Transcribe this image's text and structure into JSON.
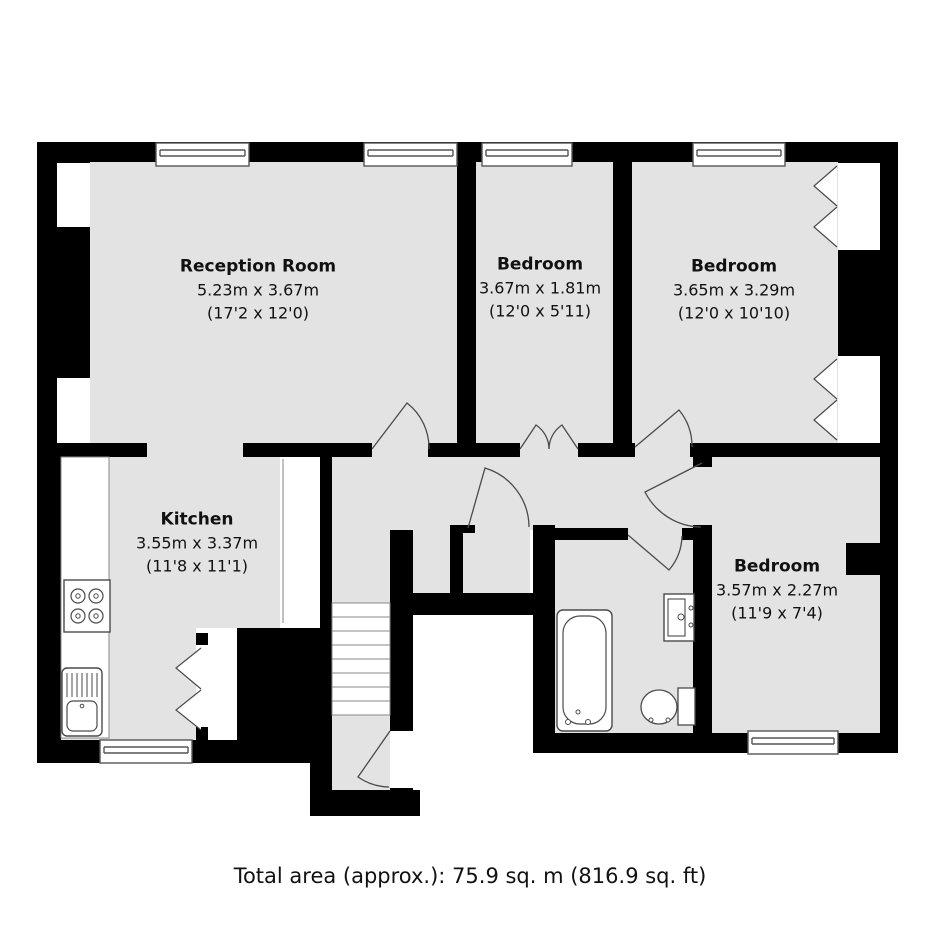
{
  "plan": {
    "type": "residential-floorplan",
    "rooms": [
      {
        "name": "Reception Room",
        "size_metric": "5.23m x 3.67m",
        "size_imperial": "(17'2 x 12'0)"
      },
      {
        "name": "Bedroom",
        "size_metric": "3.67m x 1.81m",
        "size_imperial": "(12'0 x 5'11)"
      },
      {
        "name": "Bedroom",
        "size_metric": "3.65m x 3.29m",
        "size_imperial": "(12'0 x 10'10)"
      },
      {
        "name": "Kitchen",
        "size_metric": "3.55m x 3.37m",
        "size_imperial": "(11'8 x 11'1)"
      },
      {
        "name": "Bedroom",
        "size_metric": "3.57m x 2.27m",
        "size_imperial": "(11'9 x 7'4)"
      }
    ],
    "footer": {
      "total_area_label": "Total area (approx.): 75.9 sq. m (816.9 sq. ft)"
    },
    "colors": {
      "wall": "#000000",
      "floor": "#e3e3e3",
      "background": "#ffffff",
      "fixture_outline": "#4a4a4a",
      "text": "#111111"
    },
    "fixtures": [
      "staircase",
      "bathtub",
      "washbasin",
      "toilet",
      "hob",
      "kitchen-sink"
    ],
    "features": [
      "windows",
      "door-swings",
      "bifold-wardrobes",
      "under-stair-cupboard"
    ]
  }
}
